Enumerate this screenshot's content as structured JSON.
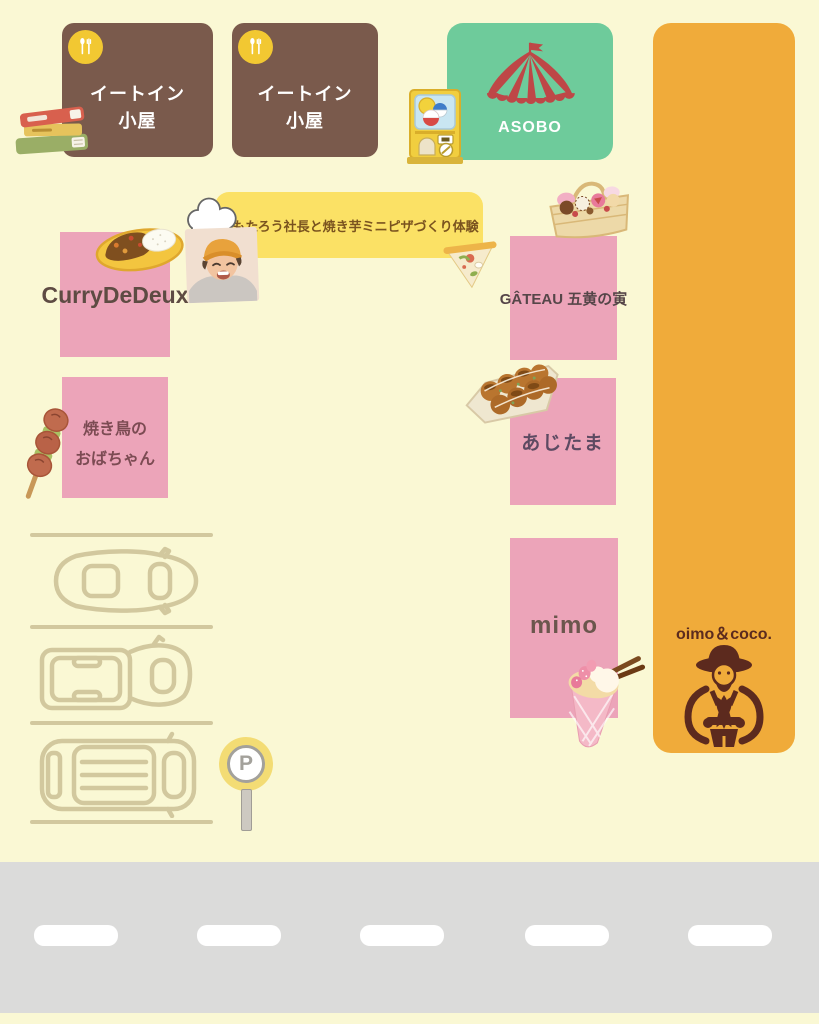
{
  "colors": {
    "background": "#FAF8D4",
    "hut_brown": "#7A5A4C",
    "stall_pink": "#ECA4B9",
    "asobo_green": "#6ECB9B",
    "oimo_orange": "#F0AB3A",
    "banner_yellow": "#FBE165",
    "tent_red": "#BE4747",
    "road_gray": "#DBDBDA",
    "parking_line_tan": "#D2C89E"
  },
  "stalls": {
    "eat_in_1": {
      "line1": "イートイン",
      "line2": "小屋"
    },
    "eat_in_2": {
      "line1": "イートイン",
      "line2": "小屋"
    },
    "asobo": {
      "label": "ASOBO"
    },
    "curry": {
      "label": "CurryDeDeux"
    },
    "yakitori": {
      "line1": "焼き鳥の",
      "line2": "おばちゃん"
    },
    "gateau": {
      "label": "GÂTEAU 五黄の寅"
    },
    "ajitama": {
      "label": "あじたま"
    },
    "mimo": {
      "label": "mimo"
    },
    "oimo": {
      "label": "oimo＆coco."
    }
  },
  "banner": {
    "label": "いもたろう社長と焼き芋ミニピザづくり体験"
  },
  "parking": {
    "sign_letter": "P"
  },
  "icons": [
    "utensils-icon",
    "books-icon",
    "gacha-machine-icon",
    "circus-tent-icon",
    "sweets-basket-icon",
    "pizza-slice-icon",
    "chef-hat-icon",
    "chef-photo",
    "curry-plate-icon",
    "yakitori-skewer-icon",
    "takoyaki-icon",
    "crepe-icon",
    "sweet-potato-farmer-icon",
    "car-outline-icon",
    "parking-sign-icon"
  ]
}
